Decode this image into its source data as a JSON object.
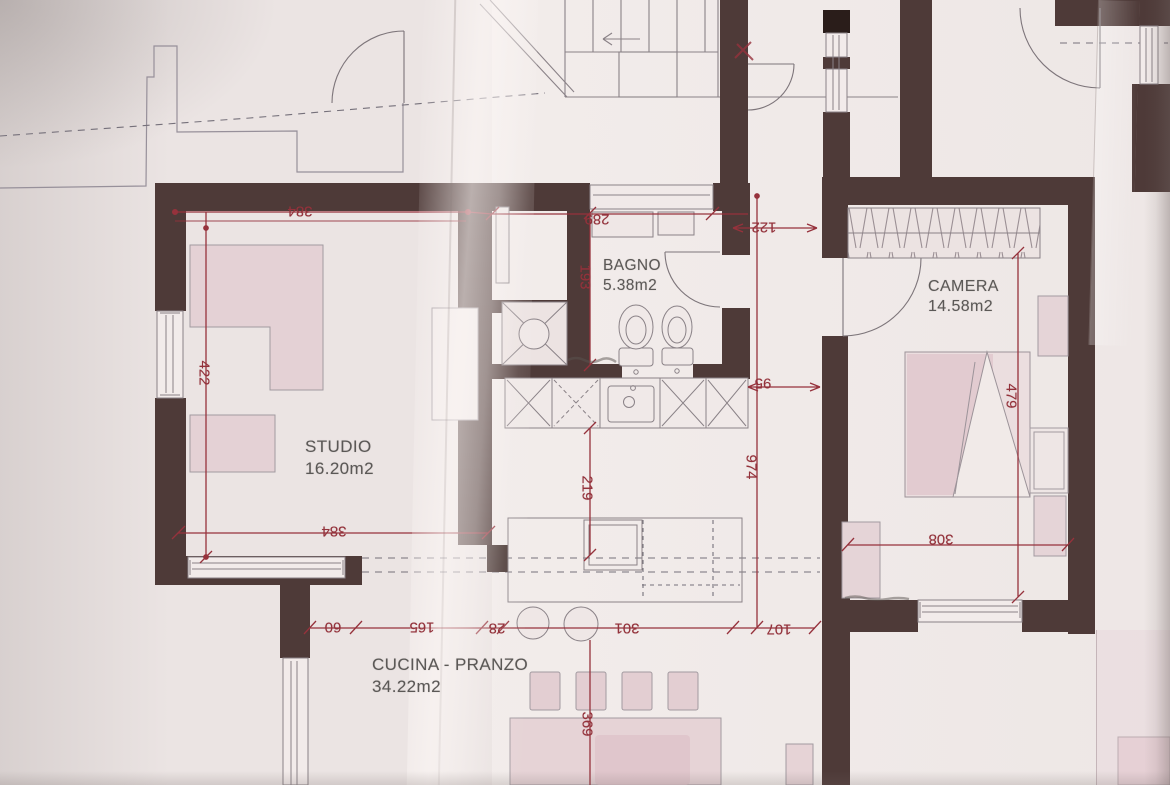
{
  "document": {
    "type": "scanned-floor-plan-photo",
    "language": "it"
  },
  "rooms": {
    "studio": {
      "name": "STUDIO",
      "area": "16.20m2"
    },
    "bagno": {
      "name": "BAGNO",
      "area": "5.38m2"
    },
    "camera": {
      "name": "CAMERA",
      "area": "14.58m2"
    },
    "cucina": {
      "name": "CUCINA - PRANZO",
      "area": "34.22m2"
    }
  },
  "dims": {
    "d384_top": "384",
    "d422": "422",
    "d384_bottom": "384",
    "d289": "289",
    "d193": "193",
    "d122": "122",
    "d95": "95",
    "d974": "974",
    "d219": "219",
    "d479": "479",
    "d308": "308",
    "d60": "60",
    "d165": "165",
    "d28": "28",
    "d301": "301",
    "d107": "107",
    "d369": "369"
  },
  "colors": {
    "wall": "#4e3a38",
    "dimension_red": "#96323c",
    "furniture_pink": "#e4d1d5",
    "paper": "#ebe4e3",
    "label_gray": "#5b5856"
  }
}
